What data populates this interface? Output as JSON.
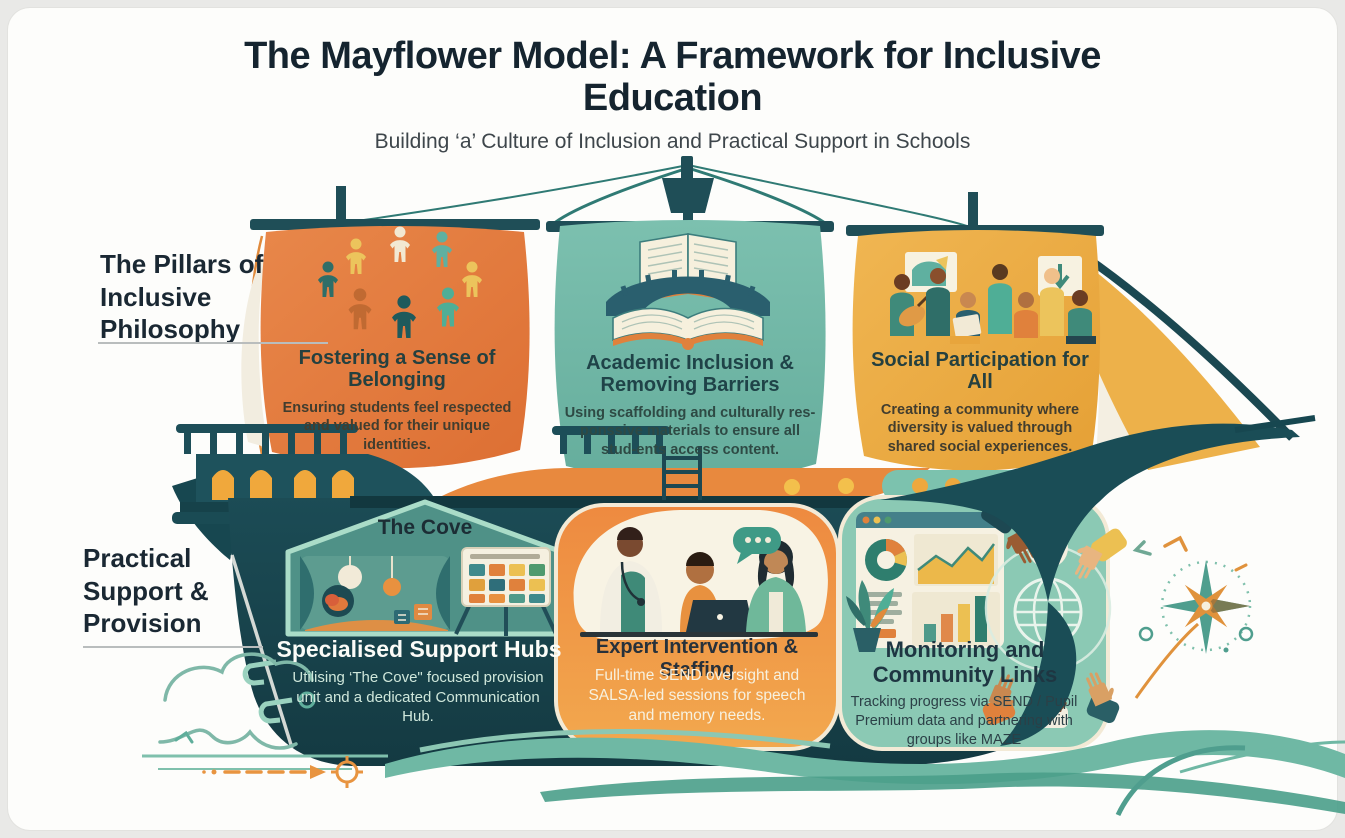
{
  "title": "The Mayflower Model: A Framework for Inclusive Education",
  "subtitle": "Building ‘a’ Culture of Inclusion and Practical Support in Schools",
  "sections": {
    "philosophy": {
      "label": "The Pillars of Inclusive Philosophy"
    },
    "practical": {
      "label": "Practical Support & Provision"
    }
  },
  "sails": [
    {
      "icon": "people-circle-icon",
      "color": "#e2793c",
      "title": "Fostering a Sense of Belonging",
      "description": "Ensuring students feel respected and valued for their unique identities."
    },
    {
      "icon": "book-bridge-icon",
      "color": "#6db5a4",
      "title": "Academic Inclusion & Removing Barriers",
      "description": "Using scaffolding and culturally res-ponssive materials to ensure all stud-ents access content."
    },
    {
      "icon": "community-activity-icon",
      "color": "#eaa93e",
      "title": "Social Participation for All",
      "description": "Creating a community where diversity is valued through shared social experiences."
    }
  ],
  "hull": [
    {
      "icon": "cove-room-icon",
      "panel_title": "The Cove",
      "title": "Specialised Support Hubs",
      "description": "Utilising ‘The Cove\" focused provision unit and a dedicated Communication Hub."
    },
    {
      "icon": "consultation-icon",
      "title": "Expert Intervention & Staffing",
      "description": "Full-time SEND oversight and SALSA-led sessions for speech and memory needs."
    },
    {
      "icon": "dashboard-globe-icon",
      "title": "Monitoring and Community Links",
      "description": "Tracking progress via SEND / Pupil Premium data and partnering with groups like MAZE"
    }
  ],
  "colors": {
    "navy_text": "#15242f",
    "hull_teal": "#1b4851",
    "sail_orange": "#e2793c",
    "sail_teal": "#6db5a4",
    "sail_yellow": "#eaa93e",
    "wave_teal": "#5fae9b",
    "accent_orange": "#e89440"
  }
}
